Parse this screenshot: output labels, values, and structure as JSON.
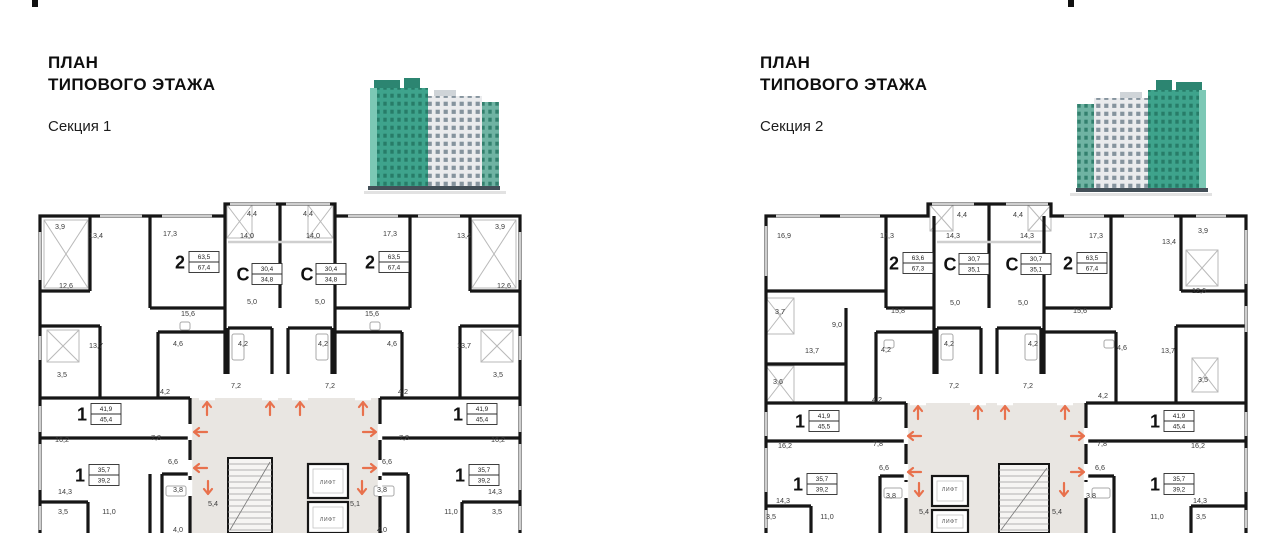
{
  "colors": {
    "wall": "#161616",
    "core_fill": "#e9e6e2",
    "arrow": "#e8714d",
    "thin": "#a8a8a8",
    "window": "#cfcfcf",
    "label_text": "#3a3a3a",
    "badge_border": "#2b2b2b",
    "green": "#3ea38c",
    "green_dark": "#1f6f5c",
    "green_light": "#7cc8b5",
    "roof_green": "#2c8571",
    "white_tower": "#eaebed",
    "white_tower_win": "#6b7d8a",
    "teal_wing": "#6fb3a3",
    "base_dark": "#434f58"
  },
  "sections": [
    {
      "title_line1": "ПЛАН",
      "title_line2": "ТИПОВОГО ЭТАЖА",
      "subtitle": "Секция 1",
      "lift_label": "ЛИФТ",
      "apartments": [
        {
          "type": "2",
          "living": "63,5",
          "total": "67,4",
          "x": 160,
          "y": 66
        },
        {
          "type": "С",
          "living": "30,4",
          "total": "34,8",
          "x": 223,
          "y": 78
        },
        {
          "type": "С",
          "living": "30,4",
          "total": "34,8",
          "x": 287,
          "y": 78
        },
        {
          "type": "2",
          "living": "63,5",
          "total": "67,4",
          "x": 350,
          "y": 66
        },
        {
          "type": "1",
          "living": "41,9",
          "total": "45,4",
          "x": 62,
          "y": 218
        },
        {
          "type": "1",
          "living": "35,7",
          "total": "39,2",
          "x": 60,
          "y": 279
        },
        {
          "type": "1",
          "living": "41,9",
          "total": "45,4",
          "x": 438,
          "y": 218
        },
        {
          "type": "1",
          "living": "35,7",
          "total": "39,2",
          "x": 440,
          "y": 279
        }
      ],
      "rooms": [
        {
          "a": "3,9",
          "x": 30,
          "y": 33
        },
        {
          "a": "13,4",
          "x": 66,
          "y": 42
        },
        {
          "a": "17,3",
          "x": 140,
          "y": 40
        },
        {
          "a": "4,4",
          "x": 222,
          "y": 20
        },
        {
          "a": "14,0",
          "x": 217,
          "y": 42
        },
        {
          "a": "14,0",
          "x": 283,
          "y": 42
        },
        {
          "a": "4,4",
          "x": 278,
          "y": 20
        },
        {
          "a": "17,3",
          "x": 360,
          "y": 40
        },
        {
          "a": "13,4",
          "x": 434,
          "y": 42
        },
        {
          "a": "3,9",
          "x": 470,
          "y": 33
        },
        {
          "a": "12,6",
          "x": 36,
          "y": 92
        },
        {
          "a": "15,6",
          "x": 158,
          "y": 120
        },
        {
          "a": "5,0",
          "x": 222,
          "y": 108
        },
        {
          "a": "5,0",
          "x": 290,
          "y": 108
        },
        {
          "a": "15,6",
          "x": 342,
          "y": 120
        },
        {
          "a": "12,6",
          "x": 474,
          "y": 92
        },
        {
          "a": "13,7",
          "x": 66,
          "y": 152
        },
        {
          "a": "4,6",
          "x": 148,
          "y": 150
        },
        {
          "a": "4,2",
          "x": 213,
          "y": 150
        },
        {
          "a": "4,2",
          "x": 293,
          "y": 150
        },
        {
          "a": "4,6",
          "x": 362,
          "y": 150
        },
        {
          "a": "13,7",
          "x": 434,
          "y": 152
        },
        {
          "a": "3,5",
          "x": 32,
          "y": 181
        },
        {
          "a": "4,2",
          "x": 135,
          "y": 198
        },
        {
          "a": "7,2",
          "x": 206,
          "y": 192
        },
        {
          "a": "7,2",
          "x": 300,
          "y": 192
        },
        {
          "a": "4,2",
          "x": 373,
          "y": 198
        },
        {
          "a": "3,5",
          "x": 468,
          "y": 181
        },
        {
          "a": "16,2",
          "x": 32,
          "y": 246
        },
        {
          "a": "7,8",
          "x": 126,
          "y": 244
        },
        {
          "a": "7,8",
          "x": 374,
          "y": 244
        },
        {
          "a": "16,2",
          "x": 468,
          "y": 246
        },
        {
          "a": "6,6",
          "x": 143,
          "y": 268
        },
        {
          "a": "6,6",
          "x": 357,
          "y": 268
        },
        {
          "a": "14,3",
          "x": 35,
          "y": 298
        },
        {
          "a": "3,8",
          "x": 148,
          "y": 296
        },
        {
          "a": "5,4",
          "x": 183,
          "y": 310
        },
        {
          "a": "5,1",
          "x": 325,
          "y": 310
        },
        {
          "a": "3,8",
          "x": 352,
          "y": 296
        },
        {
          "a": "14,3",
          "x": 465,
          "y": 298
        },
        {
          "a": "3,5",
          "x": 33,
          "y": 318
        },
        {
          "a": "11,0",
          "x": 79,
          "y": 318
        },
        {
          "a": "11,0",
          "x": 421,
          "y": 318
        },
        {
          "a": "3,5",
          "x": 467,
          "y": 318
        },
        {
          "a": "4,0",
          "x": 148,
          "y": 336
        },
        {
          "a": "4,0",
          "x": 352,
          "y": 336
        }
      ],
      "lifts": [
        {
          "x": 298,
          "y": 288
        },
        {
          "x": 298,
          "y": 325
        }
      ],
      "arrows": [
        {
          "d": "up",
          "x": 177,
          "y": 212
        },
        {
          "d": "up",
          "x": 240,
          "y": 212
        },
        {
          "d": "up",
          "x": 270,
          "y": 212
        },
        {
          "d": "up",
          "x": 333,
          "y": 212
        },
        {
          "d": "left",
          "x": 170,
          "y": 236
        },
        {
          "d": "left",
          "x": 170,
          "y": 272
        },
        {
          "d": "right",
          "x": 340,
          "y": 236
        },
        {
          "d": "right",
          "x": 340,
          "y": 272
        },
        {
          "d": "down",
          "x": 178,
          "y": 292
        },
        {
          "d": "down",
          "x": 332,
          "y": 292
        }
      ]
    },
    {
      "title_line1": "ПЛАН",
      "title_line2": "ТИПОВОГО ЭТАЖА",
      "subtitle": "Секция 2",
      "lift_label": "ЛИФТ",
      "apartments": [
        {
          "type": "2",
          "living": "63,6",
          "total": "67,3",
          "x": 148,
          "y": 67
        },
        {
          "type": "С",
          "living": "30,7",
          "total": "35,1",
          "x": 204,
          "y": 68
        },
        {
          "type": "С",
          "living": "30,7",
          "total": "35,1",
          "x": 266,
          "y": 68
        },
        {
          "type": "2",
          "living": "63,5",
          "total": "67,4",
          "x": 322,
          "y": 67
        },
        {
          "type": "1",
          "living": "41,9",
          "total": "45,5",
          "x": 54,
          "y": 225
        },
        {
          "type": "1",
          "living": "35,7",
          "total": "39,2",
          "x": 52,
          "y": 288
        },
        {
          "type": "1",
          "living": "41,9",
          "total": "45,4",
          "x": 409,
          "y": 225
        },
        {
          "type": "1",
          "living": "35,7",
          "total": "39,2",
          "x": 409,
          "y": 288
        }
      ],
      "rooms": [
        {
          "a": "16,9",
          "x": 28,
          "y": 42
        },
        {
          "a": "17,3",
          "x": 131,
          "y": 42
        },
        {
          "a": "14,3",
          "x": 197,
          "y": 42
        },
        {
          "a": "4,4",
          "x": 206,
          "y": 21
        },
        {
          "a": "4,4",
          "x": 262,
          "y": 21
        },
        {
          "a": "14,3",
          "x": 271,
          "y": 42
        },
        {
          "a": "17,3",
          "x": 340,
          "y": 42
        },
        {
          "a": "13,4",
          "x": 413,
          "y": 48
        },
        {
          "a": "3,9",
          "x": 447,
          "y": 37
        },
        {
          "a": "3,7",
          "x": 24,
          "y": 118
        },
        {
          "a": "9,0",
          "x": 81,
          "y": 131
        },
        {
          "a": "15,8",
          "x": 142,
          "y": 117
        },
        {
          "a": "5,0",
          "x": 199,
          "y": 109
        },
        {
          "a": "5,0",
          "x": 267,
          "y": 109
        },
        {
          "a": "15,6",
          "x": 324,
          "y": 117
        },
        {
          "a": "12,6",
          "x": 443,
          "y": 97
        },
        {
          "a": "13,7",
          "x": 56,
          "y": 157
        },
        {
          "a": "4,2",
          "x": 130,
          "y": 156
        },
        {
          "a": "4,2",
          "x": 193,
          "y": 150
        },
        {
          "a": "4,2",
          "x": 277,
          "y": 150
        },
        {
          "a": "4,6",
          "x": 366,
          "y": 154
        },
        {
          "a": "13,7",
          "x": 412,
          "y": 157
        },
        {
          "a": "3,6",
          "x": 22,
          "y": 188
        },
        {
          "a": "7,2",
          "x": 198,
          "y": 192
        },
        {
          "a": "7,2",
          "x": 272,
          "y": 192
        },
        {
          "a": "4,2",
          "x": 347,
          "y": 202
        },
        {
          "a": "3,5",
          "x": 447,
          "y": 186
        },
        {
          "a": "4,2",
          "x": 121,
          "y": 206
        },
        {
          "a": "16,2",
          "x": 29,
          "y": 252
        },
        {
          "a": "7,8",
          "x": 122,
          "y": 250
        },
        {
          "a": "7,8",
          "x": 346,
          "y": 250
        },
        {
          "a": "16,2",
          "x": 442,
          "y": 252
        },
        {
          "a": "6,6",
          "x": 128,
          "y": 274
        },
        {
          "a": "6,6",
          "x": 344,
          "y": 274
        },
        {
          "a": "14,3",
          "x": 27,
          "y": 307
        },
        {
          "a": "3,8",
          "x": 135,
          "y": 302
        },
        {
          "a": "5,4",
          "x": 168,
          "y": 318
        },
        {
          "a": "5,4",
          "x": 301,
          "y": 318
        },
        {
          "a": "3,8",
          "x": 335,
          "y": 302
        },
        {
          "a": "14,3",
          "x": 444,
          "y": 307
        },
        {
          "a": "3,5",
          "x": 15,
          "y": 323
        },
        {
          "a": "11,0",
          "x": 71,
          "y": 323
        },
        {
          "a": "11,0",
          "x": 401,
          "y": 323
        },
        {
          "a": "3,5",
          "x": 445,
          "y": 323
        }
      ],
      "lifts": [
        {
          "x": 194,
          "y": 295
        },
        {
          "x": 194,
          "y": 327
        }
      ],
      "arrows": [
        {
          "d": "up",
          "x": 162,
          "y": 216
        },
        {
          "d": "up",
          "x": 222,
          "y": 216
        },
        {
          "d": "up",
          "x": 249,
          "y": 216
        },
        {
          "d": "up",
          "x": 309,
          "y": 216
        },
        {
          "d": "left",
          "x": 158,
          "y": 240
        },
        {
          "d": "left",
          "x": 158,
          "y": 276
        },
        {
          "d": "right",
          "x": 322,
          "y": 240
        },
        {
          "d": "right",
          "x": 322,
          "y": 276
        },
        {
          "d": "down",
          "x": 163,
          "y": 294
        },
        {
          "d": "down",
          "x": 308,
          "y": 294
        }
      ]
    }
  ]
}
